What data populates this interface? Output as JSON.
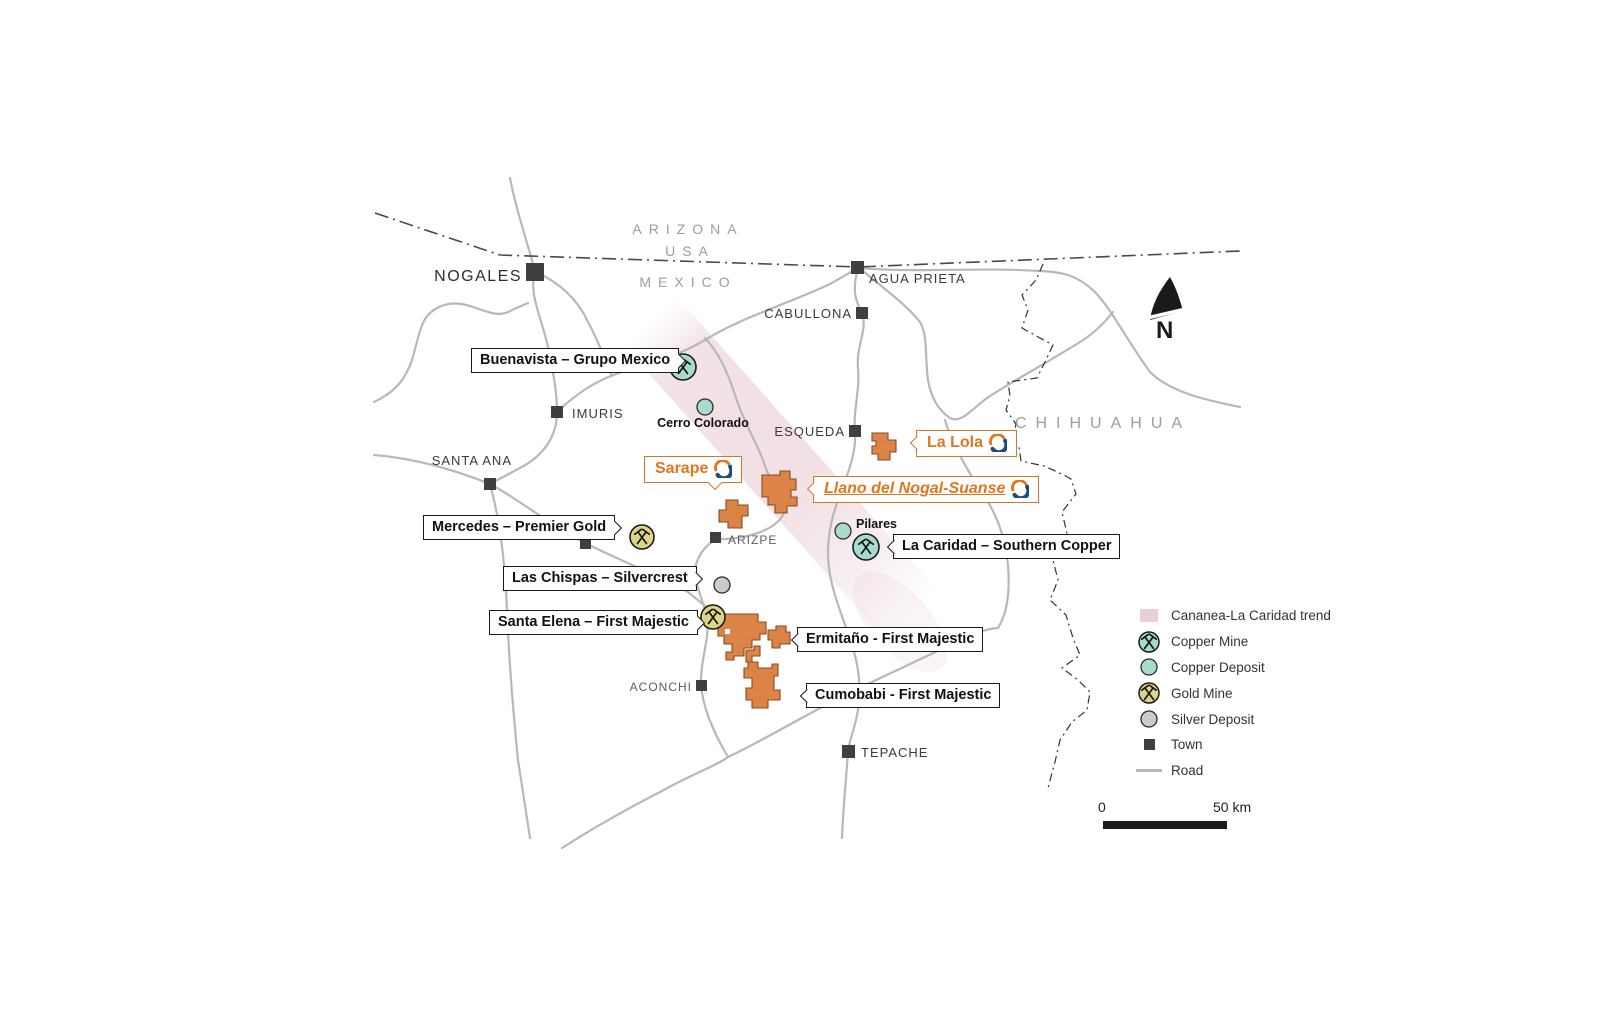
{
  "regions": [
    {
      "name": "ARIZONA"
    },
    {
      "name": "USA"
    },
    {
      "name": "MEXICO"
    },
    {
      "name": "CHIHUAHUA"
    }
  ],
  "towns": [
    {
      "name": "NOGALES"
    },
    {
      "name": "AGUA PRIETA"
    },
    {
      "name": "CABULLONA"
    },
    {
      "name": "IMURIS"
    },
    {
      "name": "SANTA ANA"
    },
    {
      "name": "ESQUEDA"
    },
    {
      "name": "ARIZPE"
    },
    {
      "name": "ACONCHI"
    },
    {
      "name": "TEPACHE"
    }
  ],
  "deposits": [
    {
      "name": "Cerro Colorado",
      "type": "copper-deposit"
    },
    {
      "name": "Pilares",
      "type": "copper-deposit"
    }
  ],
  "mine_callouts": [
    {
      "label": "Buenavista – Grupo Mexico",
      "type": "copper-mine"
    },
    {
      "label": "Mercedes – Premier Gold",
      "type": "gold-mine"
    },
    {
      "label": "Las Chispas – Silvercrest",
      "type": "silver-deposit"
    },
    {
      "label": "Santa Elena – First Majestic",
      "type": "gold-mine"
    },
    {
      "label": "Ermitaño - First Majestic",
      "type": "property"
    },
    {
      "label": "Cumobabi - First Majestic",
      "type": "property"
    },
    {
      "label": "La Caridad – Southern Copper",
      "type": "copper-mine"
    }
  ],
  "company_callouts": [
    {
      "label": "Sarape"
    },
    {
      "label": "La Lola"
    },
    {
      "label": "Llano del Nogal-Suanse"
    }
  ],
  "legend": {
    "items": [
      {
        "label": "Cananea-La Caridad  trend",
        "symbol": "trend-swatch"
      },
      {
        "label": "Copper Mine",
        "symbol": "copper-mine"
      },
      {
        "label": "Copper Deposit",
        "symbol": "copper-deposit"
      },
      {
        "label": "Gold Mine",
        "symbol": "gold-mine"
      },
      {
        "label": "Silver Deposit",
        "symbol": "silver-deposit"
      },
      {
        "label": "Town",
        "symbol": "town"
      },
      {
        "label": "Road",
        "symbol": "road"
      }
    ]
  },
  "scale_bar": {
    "start": "0",
    "end": "50 km"
  },
  "north": "N",
  "colors": {
    "copper": "#A7DBD0",
    "gold": "#DDD488",
    "silver": "#CBCBCB",
    "property_orange": "#DC8448",
    "property_border": "#8A4A1A",
    "label_orange": "#D9752A",
    "logo_navy": "#1F4C7C",
    "trend_pink": "#E8CBD1",
    "road_gray": "#B8B8B8",
    "town_dark": "#3F3F3F"
  }
}
